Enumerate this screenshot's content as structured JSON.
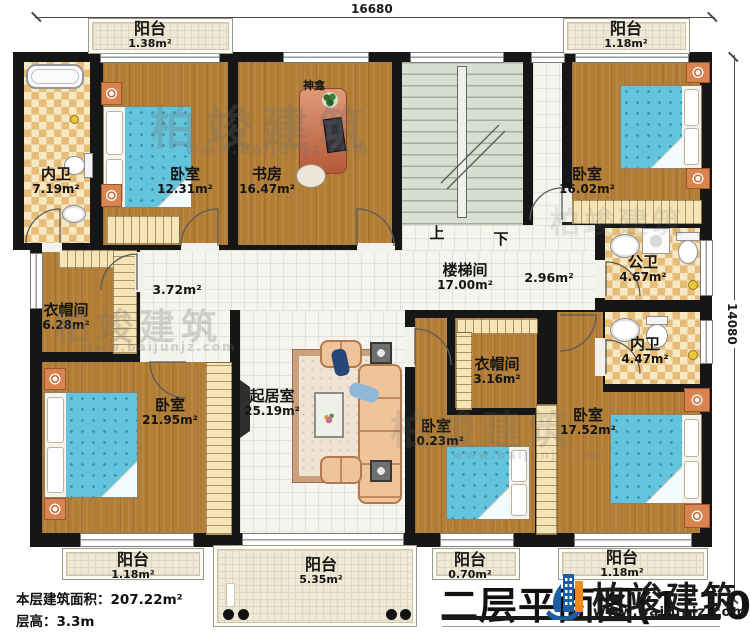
{
  "dimensions": {
    "top": "16680",
    "right": "14080"
  },
  "watermark": {
    "brand": "柏竣建筑",
    "url": "www.baijunjz.com"
  },
  "labels": {
    "shrine": "神龛",
    "up": "上",
    "down": "下",
    "stair_name": "楼梯间",
    "stair_area": "17.00m²",
    "hall_left_area": "3.72m²",
    "hall_right_area": "2.96m²"
  },
  "rooms": [
    {
      "name": "阳台",
      "area": "1.38m²"
    },
    {
      "name": "内卫",
      "area": "7.19m²"
    },
    {
      "name": "卧室",
      "area": "12.31m²"
    },
    {
      "name": "书房",
      "area": "16.47m²"
    },
    {
      "name": "卧室",
      "area": "16.02m²"
    },
    {
      "name": "阳台",
      "area": "1.18m²"
    },
    {
      "name": "衣帽间",
      "area": "6.28m²"
    },
    {
      "name": "公卫",
      "area": "4.67m²"
    },
    {
      "name": "内卫",
      "area": "4.47m²"
    },
    {
      "name": "卧室",
      "area": "21.95m²"
    },
    {
      "name": "起居室",
      "area": "25.19m²"
    },
    {
      "name": "衣帽间",
      "area": "3.16m²"
    },
    {
      "name": "卧室",
      "area": "10.23m²"
    },
    {
      "name": "卧室",
      "area": "17.52m²"
    },
    {
      "name": "阳台",
      "area": "1.18m²"
    },
    {
      "name": "阳台",
      "area": "5.35m²"
    },
    {
      "name": "阳台",
      "area": "0.70m²"
    },
    {
      "name": "阳台",
      "area": "1.18m²"
    }
  ],
  "footer": {
    "floor_area_label": "本层建筑面积：",
    "floor_area_value": "207.22m²",
    "floor_height_label": "层高：",
    "floor_height_value": "3.3m",
    "title": "二层平面图(1:100)"
  },
  "logo": {
    "brand": "柏竣建筑",
    "url": "www.baijunjz.com"
  }
}
